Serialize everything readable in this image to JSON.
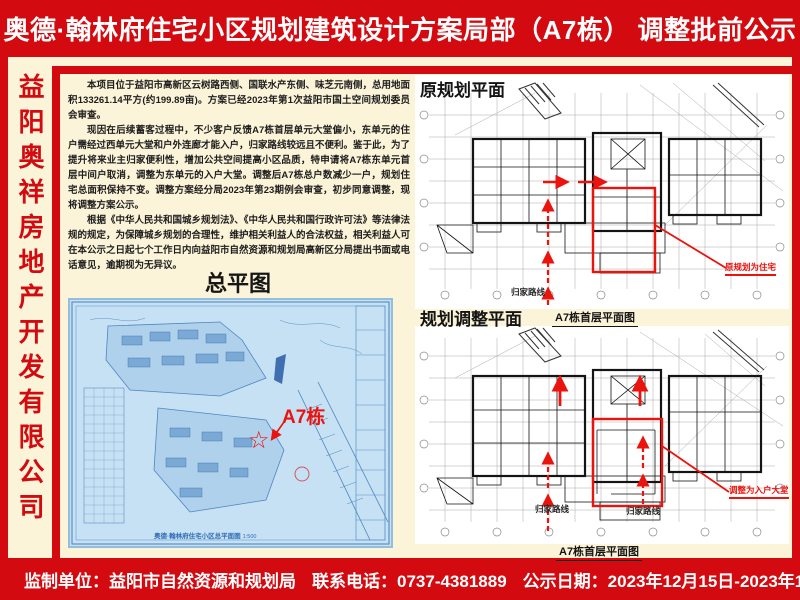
{
  "title": "奥德·翰林府住宅小区规划建筑设计方案局部（A7栋） 调整批前公示",
  "sidebar": {
    "company": "益阳奥祥房地产开发有限公司"
  },
  "notice": {
    "paragraphs": [
      "本项目位于益阳市高新区云树路西侧、国联水产东侧、味芝元南侧，总用地面积133261.14平方(约199.89亩)。方案已经2023年第1次益阳市国土空间规划委员会审查。",
      "现因在后续蓄客过程中，不少客户反馈A7栋首层单元大堂偏小，东单元的住户需经过西单元大堂和户外连廊才能入户，归家路线较远且不便利。鉴于此，为了提升将来业主归家便利性，增加公共空间提高小区品质，特申请将A7栋东单元首层中间户取消，调整为东单元的入户大堂。调整后A7栋总户数减少一户，规划住宅总面积保持不变。调整方案经分局2023年第23期例会审查，初步同意调整，现将调整方案公示。",
      "根据《中华人民共和国城乡规划法》、《中华人民共和国行政许可法》等法律法规的规定，为保障城乡规划的合理性，维护相关利益人的合法权益，相关利益人可在本公示之日起七个工作日内向益阳市自然资源和规划局高新区分局提出书面或电话意见，逾期视为无异议。"
    ]
  },
  "site_plan": {
    "heading": "总平图",
    "building_label": "A7栋",
    "star_glyph": "☆",
    "drawing_title": "奥德·翰林府住宅小区总平面图",
    "drawing_scale": "1:500"
  },
  "original_plan": {
    "heading": "原规划平面",
    "caption": "A7栋首层平面图",
    "route_label": "归家路线",
    "annotation": "原规划为住宅"
  },
  "adjusted_plan": {
    "heading": "规划调整平面",
    "caption": "A7栋首层平面图",
    "route_label_left": "归家路线",
    "route_label_right": "归家路线",
    "annotation": "调整为入户大堂"
  },
  "footer": {
    "supervisor_label": "监制单位：",
    "supervisor": "益阳市自然资源和规划局",
    "phone_label": "联系电话：",
    "phone": "0737-4381889",
    "date_label": "公示日期：",
    "date_range": "2023年12月15日-2023年12月25日"
  },
  "colors": {
    "poster_red": "#d30b10",
    "annotation_red": "#ea130d",
    "cream": "#fcf4d9",
    "blueprint_bg": "#c6e0f4",
    "blueprint_line": "#4d86c0"
  }
}
